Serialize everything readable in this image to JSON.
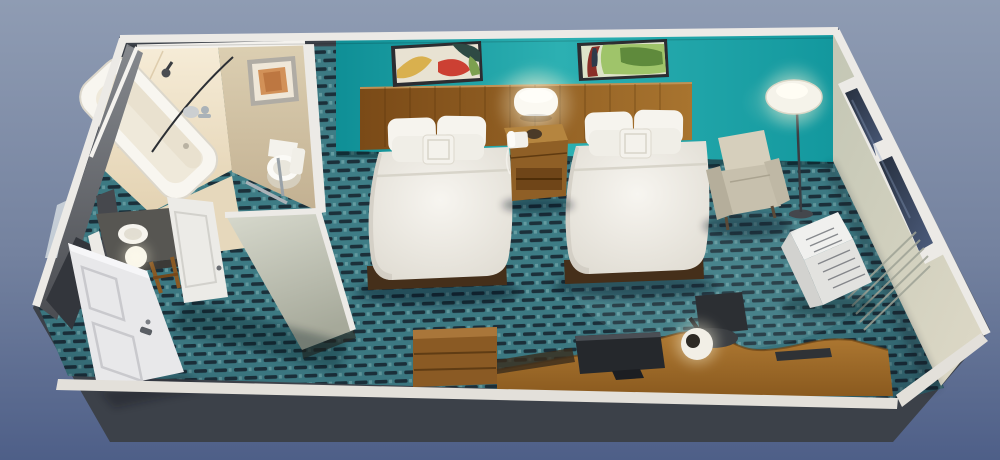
{
  "scene": {
    "type": "3d-room-render",
    "title": "Hotel guest room 3D cutaway render: two double beds, bathroom, desk area",
    "areas": [
      "bathroom",
      "entry",
      "bedroom"
    ],
    "objects": [
      "bathtub",
      "shower-head",
      "shower-curtain-rod",
      "bathroom-artwork",
      "toilet",
      "grab-bar",
      "vanity-counter",
      "vanity-sink",
      "sphere-lamp",
      "bathroom-door",
      "entry-door",
      "mirror",
      "wall-art-left",
      "wall-art-right",
      "headboard",
      "bed-left",
      "bed-right",
      "nightstand",
      "telephone",
      "wall-sconce",
      "armchair",
      "floor-lamp",
      "window",
      "ptac-ac-unit",
      "dresser",
      "desk",
      "monitor",
      "desk-chair",
      "desk-lamp",
      "patterned-carpet",
      "teal-accent-wall"
    ]
  },
  "colors": {
    "bg_top": "#8f9cb3",
    "bg_mid": "#74829f",
    "bg_bottom": "#4e5f88",
    "outer_wall": "#3c4149",
    "trim": "#eceae6",
    "carpet_base": "#3f7f88",
    "carpet_dark": "#16232e",
    "carpet_light": "#6fa7ab",
    "teal_a": "#0f8f96",
    "teal_b": "#2cb0b2",
    "teal_c": "#13989e",
    "cream_a": "#f6ecd7",
    "cream_b": "#e3d2b2",
    "beige_a": "#dccfb2",
    "beige_b": "#c2b091",
    "partition_a": "#d8dace",
    "partition_b": "#a6a99a",
    "leftwall_a": "#86898e",
    "leftwall_b": "#4b4d52",
    "rightwall_a": "#c3c6b4",
    "rightwall_b": "#ded9c7",
    "glass_a": "#27303f",
    "glass_b": "#4c5c7c",
    "wood_a": "#7a4a17",
    "wood_b": "#a8742f",
    "wood_nightstand": "#8f5f26",
    "wood_nightstand_top": "#b5853f",
    "wood_desk_a": "#b07a33",
    "wood_desk_b": "#8a5a1f",
    "wood_dresser": "#8a5a24",
    "bed_platform": "#452f1a",
    "bed_white": "#f7f5f0",
    "bed_edge": "#ddd9cf",
    "pillow_front": "#f0eee7",
    "monitor_dark": "#25282c",
    "chair_dark": "#2c2f33",
    "armchair_a": "#d6cfbc",
    "armchair_b": "#c7c0ad",
    "door_white": "#e8e8ea",
    "vanity_top": "#575652",
    "metal": "#aab2b8",
    "art_frame": "#2c2d31",
    "art_orange": "#d29158",
    "ac_white": "#f0f0ee",
    "lamp_white": "#fbf9f2"
  }
}
